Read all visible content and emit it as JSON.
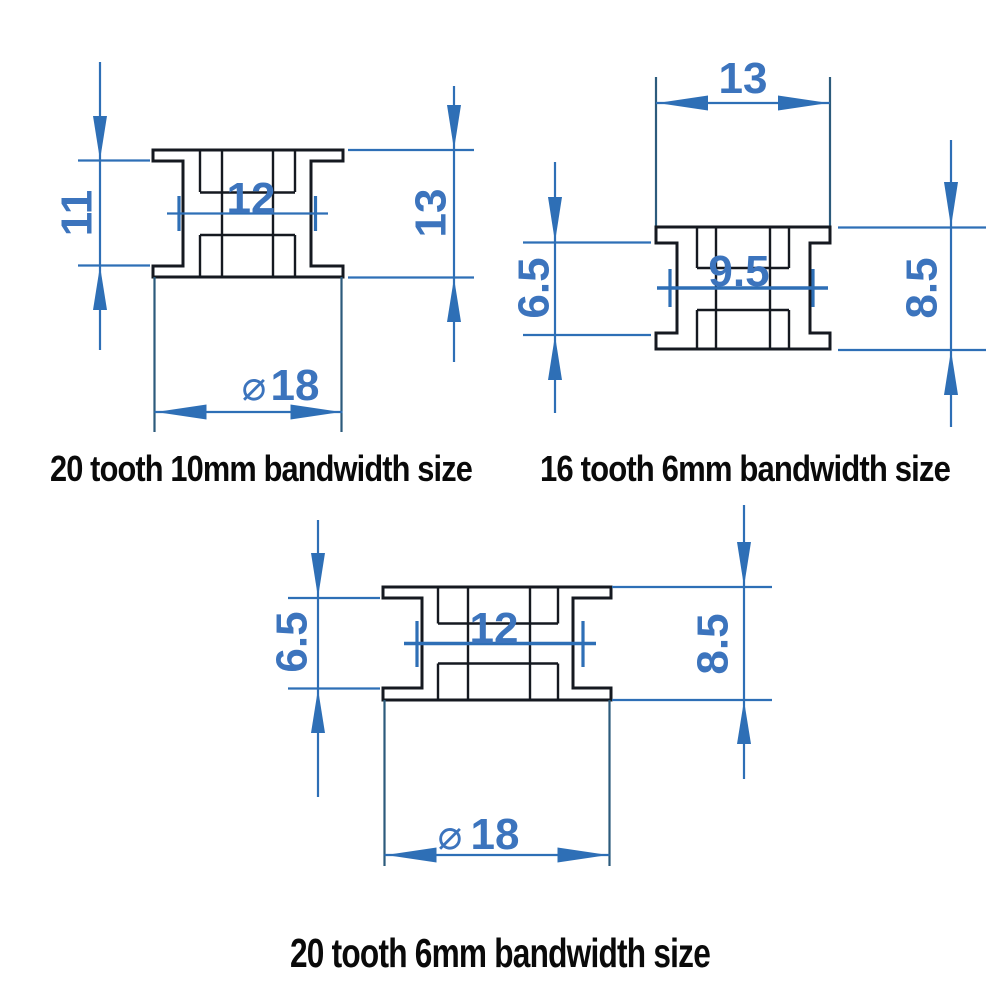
{
  "colors": {
    "background": "#ffffff",
    "outline": "#151920",
    "hub_line": "#2c5b7c",
    "dimension_blue": "#2e6fb6",
    "number_blue": "#3c74bd",
    "label_black": "#0a0a0a"
  },
  "diagrams": {
    "d1": {
      "label": "20 tooth 10mm bandwidth size",
      "dim_belt_width": "11",
      "dim_bore_width": "12",
      "dim_total_width": "13",
      "dim_diameter_symbol": "⌀",
      "dim_diameter_value": "18"
    },
    "d2": {
      "label": "16 tooth 6mm bandwidth size",
      "dim_hub_width": "13",
      "dim_belt_width": "6.5",
      "dim_bore_width": "9.5",
      "dim_total_width": "8.5"
    },
    "d3": {
      "label": "20 tooth 6mm bandwidth size",
      "dim_belt_width": "6.5",
      "dim_bore_width": "12",
      "dim_total_width": "8.5",
      "dim_diameter_symbol": "⌀",
      "dim_diameter_value": "18"
    }
  }
}
